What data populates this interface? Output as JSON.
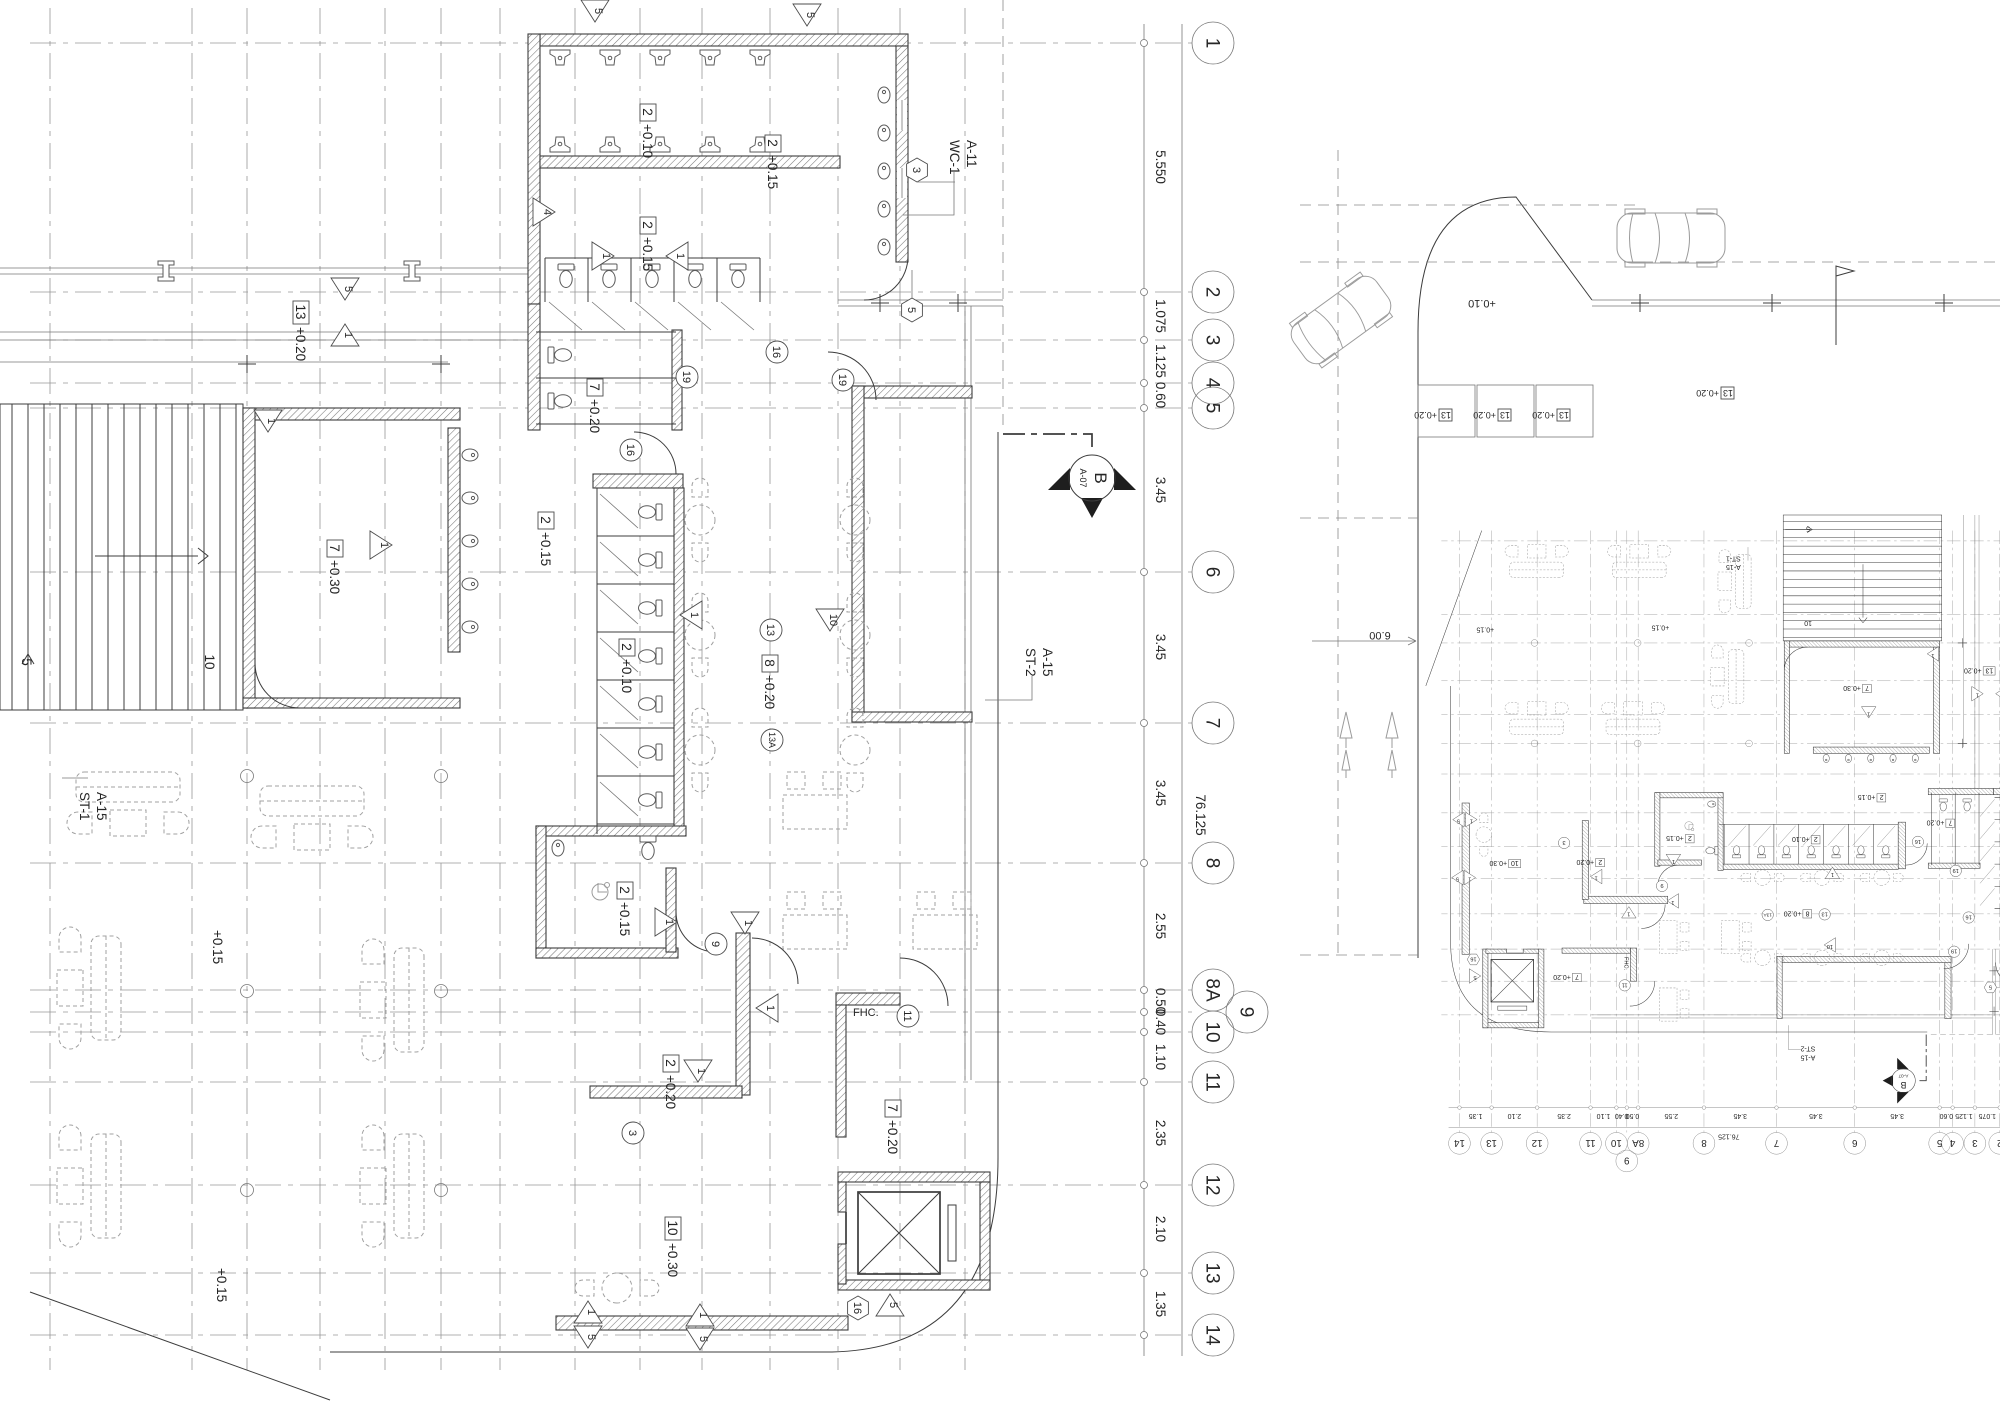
{
  "palette": {
    "line": "#3c3c3c",
    "grid": "#979797",
    "furniture": "#a0a0a0",
    "text": "#262626",
    "background": "#ffffff"
  },
  "left_plan": {
    "bubbles": [
      "1",
      "2",
      "3",
      "4",
      "5",
      "6",
      "7",
      "8",
      "8A",
      "9",
      "10",
      "11",
      "12",
      "13",
      "14"
    ],
    "dims": [
      "5.550",
      "1.075",
      "1.125",
      "0.60",
      "3.45",
      "3.45",
      "3.45",
      "2.55",
      "0.50",
      "0.40",
      "1.10",
      "2.35",
      "2.10",
      "1.35"
    ],
    "total_dim": "76.125",
    "rooms": [
      {
        "tag": "2",
        "level": "+0.10"
      },
      {
        "tag": "2",
        "level": "+0.15"
      },
      {
        "tag": "2",
        "level": "+0.15"
      },
      {
        "tag": "13",
        "level": "+0.20"
      },
      {
        "tag": "7",
        "level": "+0.30"
      },
      {
        "tag": "7",
        "level": "+0.20"
      },
      {
        "tag": "2",
        "level": "+0.15"
      },
      {
        "tag": "2",
        "level": "+0.10"
      },
      {
        "tag": "8",
        "level": "+0.20"
      },
      {
        "tag": "2",
        "level": "+0.15"
      },
      {
        "tag": "2",
        "level": "+0.20"
      },
      {
        "tag": "7",
        "level": "+0.20"
      },
      {
        "tag": "10",
        "level": "+0.30"
      }
    ],
    "area_levels": [
      "+0.15",
      "+0.15"
    ],
    "stairs": [
      {
        "name": "ST-1",
        "sheet": "A-15"
      },
      {
        "name": "ST-2",
        "sheet": "A-15"
      }
    ],
    "wc_ref": {
      "name": "WC-1",
      "sheet": "A-11"
    },
    "fhc_label": "FHC.",
    "section_marker": {
      "letter": "B",
      "sheet": "A-07"
    },
    "stair_counts": [
      "5",
      "10"
    ],
    "triangle_tags": [
      "5",
      "5",
      "4",
      "5",
      "1",
      "1",
      "1",
      "1",
      "1",
      "10",
      "1",
      "1",
      "1",
      "1",
      "1",
      "1",
      "5",
      "1",
      "5",
      "5"
    ],
    "circle_tags": [
      "16",
      "19",
      "19",
      "16",
      "9",
      "11",
      "13",
      "13A",
      "3"
    ],
    "hex_tags": [
      "3",
      "5",
      "16"
    ]
  },
  "right_plan": {
    "parking_labels": [
      {
        "tag": "13",
        "level": "+0.20"
      },
      {
        "tag": "13",
        "level": "+0.20"
      },
      {
        "tag": "13",
        "level": "+0.20"
      },
      {
        "tag": "13",
        "level": "+0.20"
      }
    ],
    "street_level": "+0.10",
    "drive_dim": "6.00"
  }
}
